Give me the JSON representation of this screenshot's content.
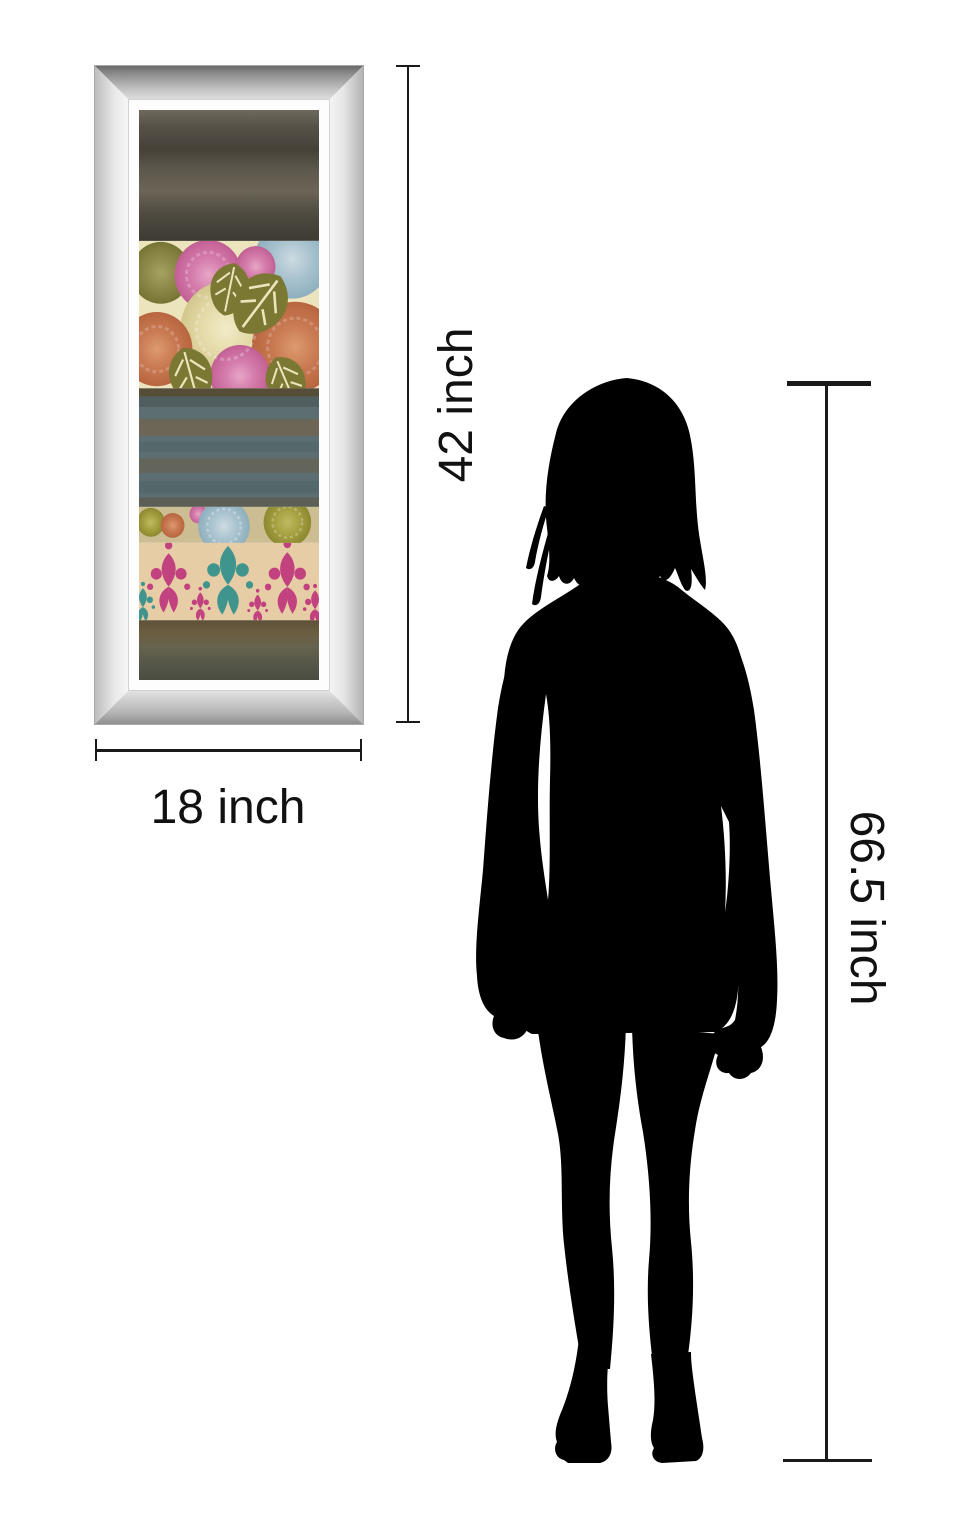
{
  "page": {
    "background_color": "#ffffff"
  },
  "artwork": {
    "frame_style": "mirrored bevel frame",
    "frame_colors": {
      "bevel_dark": "#6a6a6a",
      "bevel_light": "#ececec",
      "lip": "#fdfdfd"
    },
    "palette": {
      "band_top_dark": "#57534a",
      "floral_background_cream": "#ece4bc",
      "flower_pink": "#d57fae",
      "flower_orange": "#c97a52",
      "flower_olive": "#8c8948",
      "flower_blue": "#a9c3cf",
      "flower_cream": "#e4daa8",
      "stripe_band_bluegray": "#5d6e72",
      "stripe_brown": "#7a5f3e",
      "damask_background_tan": "#e7cda6",
      "damask_magenta": "#c2417f",
      "damask_teal": "#3f948e",
      "band_bottom_dark": "#5f5c48"
    }
  },
  "dimensions": {
    "art_height_label": "42 inch",
    "art_width_label": "18 inch",
    "person_height_label": "66.5 inch",
    "line_color": "#1a1a1a"
  },
  "silhouette": {
    "subject": "standing woman",
    "color": "#000000"
  }
}
